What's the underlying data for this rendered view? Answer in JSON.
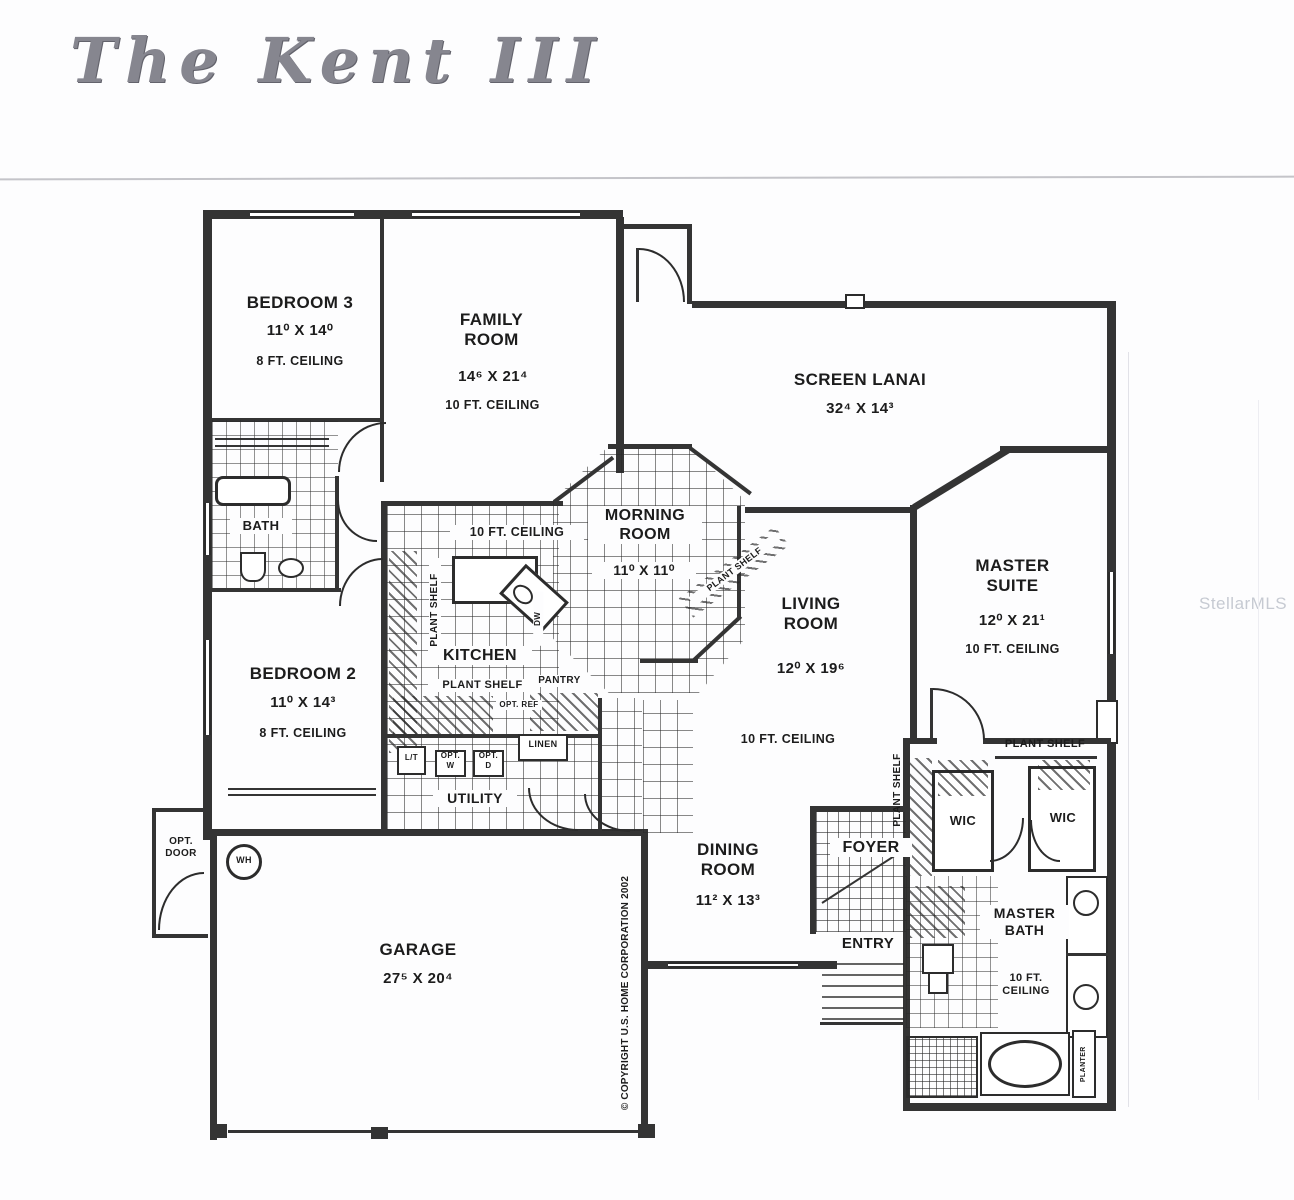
{
  "page": {
    "title": "The Kent III",
    "watermark": "StellarMLS",
    "copyright_note": "© COPYRIGHT U.S. HOME CORPORATION 2002"
  },
  "rooms": {
    "bedroom3": {
      "name": "BEDROOM 3",
      "dims": "11⁰ X 14⁰",
      "ceiling": "8 FT. CEILING"
    },
    "family_room": {
      "name": "FAMILY ROOM",
      "dims": "14⁶ X 21⁴",
      "ceiling": "10 FT. CEILING"
    },
    "screen_lanai": {
      "name": "SCREEN LANAI",
      "dims": "32⁴ X 14³"
    },
    "master_suite": {
      "name": "MASTER SUITE",
      "dims": "12⁰ X 21¹",
      "ceiling": "10 FT. CEILING"
    },
    "morning_room": {
      "name": "MORNING ROOM",
      "dims": "11⁰ X 11⁰"
    },
    "kitchen": {
      "name": "KITCHEN",
      "ceiling": "10 FT. CEILING"
    },
    "living_room": {
      "name": "LIVING ROOM",
      "dims": "12⁰ X 19⁶",
      "ceiling": "10 FT. CEILING"
    },
    "bath": {
      "name": "BATH"
    },
    "bedroom2": {
      "name": "BEDROOM 2",
      "dims": "11⁰ X 14³",
      "ceiling": "8 FT. CEILING"
    },
    "utility": {
      "name": "UTILITY"
    },
    "dining_room": {
      "name": "DINING ROOM",
      "dims": "11² X 13³"
    },
    "foyer": {
      "name": "FOYER"
    },
    "entry": {
      "name": "ENTRY"
    },
    "wic_left": {
      "name": "WIC"
    },
    "wic_right": {
      "name": "WIC"
    },
    "master_bath": {
      "name": "MASTER BATH",
      "ceiling": "10 FT. CEILING"
    },
    "garage": {
      "name": "GARAGE",
      "dims": "27⁵ X 20⁴"
    }
  },
  "labels": {
    "plant_shelf": "PLANT SHELF",
    "pantry": "PANTRY",
    "linen": "LINEN",
    "opt_ref": "OPT. REF",
    "opt_w": "OPT. W",
    "opt_d": "OPT. D",
    "laundry_tub": "L/T",
    "water_heater": "WH",
    "opt_door": "OPT. DOOR",
    "dishwasher": "DW",
    "planter": "PLANTER"
  }
}
